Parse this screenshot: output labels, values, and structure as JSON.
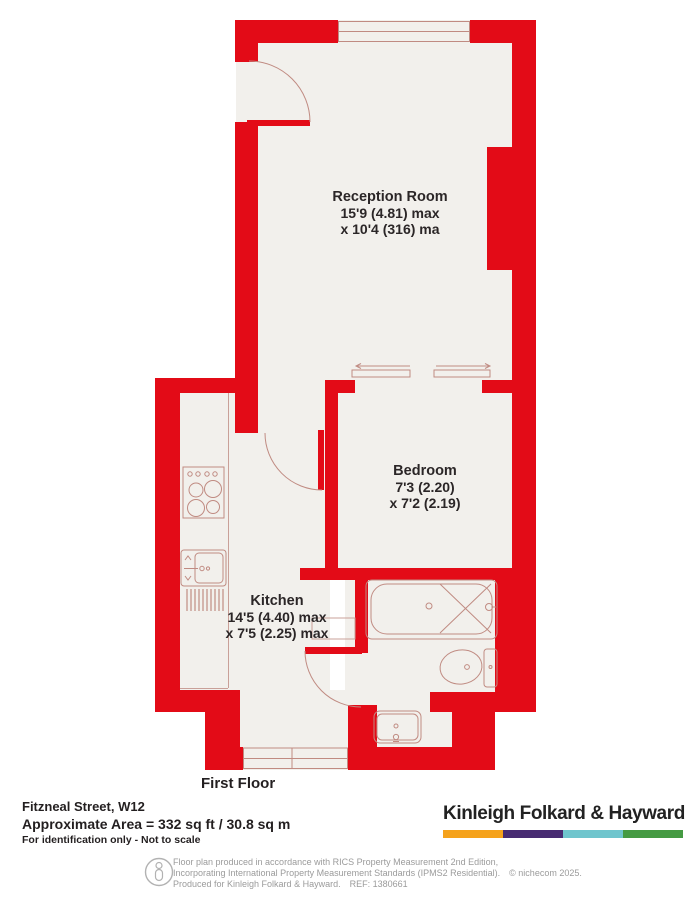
{
  "plan": {
    "floor_label": "First Floor",
    "rooms": {
      "reception": {
        "name": "Reception Room",
        "dim1": "15'9 (4.81) max",
        "dim2": "x 10'4 (316) ma"
      },
      "bedroom": {
        "name": "Bedroom",
        "dim1": "7'3 (2.20)",
        "dim2": "x 7'2 (2.19)"
      },
      "kitchen": {
        "name": "Kitchen",
        "dim1": "14'5 (4.40) max",
        "dim2": "x 7'5 (2.25) max"
      }
    },
    "fixtures": [
      "stove-icon",
      "kitchen-sink-icon",
      "drainer-icon",
      "bath-icon",
      "toilet-icon",
      "basin-icon"
    ],
    "colors": {
      "wall": "#e30b17",
      "floor": "#f2f0ec",
      "fixture_line": "#c08b82"
    }
  },
  "property": {
    "address": "Fitzneal Street, W12",
    "area": "Approximate Area = 332 sq ft / 30.8 sq m",
    "note": "For identification only - Not to scale"
  },
  "brand": {
    "name": "Kinleigh Folkard & Hayward",
    "bar_colors": [
      "#f5a21b",
      "#472b72",
      "#6fc5cd",
      "#459a43"
    ]
  },
  "footer": {
    "line1": "Floor plan produced in accordance with RICS Property Measurement 2nd Edition,",
    "line2": "Incorporating International Property Measurement Standards (IPMS2 Residential).",
    "copyright": "© nichecom 2025.",
    "line3": "Produced for Kinleigh Folkard & Hayward.",
    "ref": "REF: 1380661"
  }
}
